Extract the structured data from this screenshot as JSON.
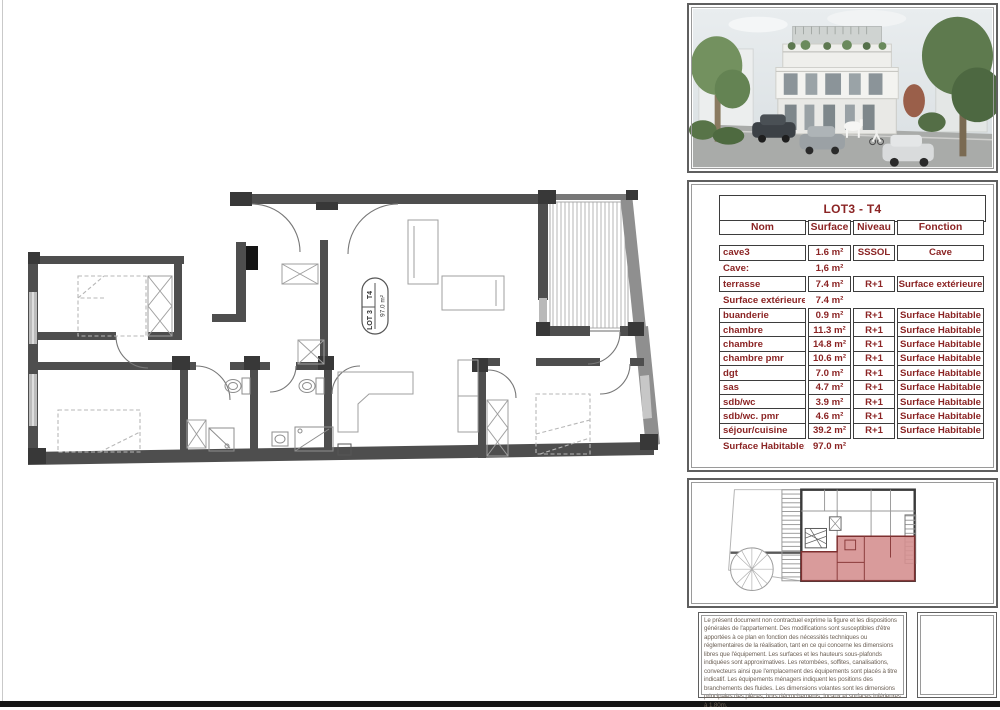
{
  "colors": {
    "accent_red": "#8b2424",
    "wall_gray": "#4e4e4e",
    "lot_highlight": "#d59090"
  },
  "plan": {
    "label": {
      "lot": "LOT 3",
      "type": "T4",
      "area": "97.0 m²"
    }
  },
  "table": {
    "title": "LOT3 - T4",
    "headers": [
      "Nom",
      "Surface",
      "Niveau",
      "Fonction"
    ],
    "rows": [
      {
        "nom": "cave3",
        "surface": "1.6 m²",
        "niveau": "SSSOL",
        "fonction": "Cave"
      },
      {
        "summary": true,
        "nom": "Cave:",
        "surface": "1,6 m²",
        "niveau": "",
        "fonction": ""
      },
      {
        "nom": "terrasse",
        "surface": "7.4 m²",
        "niveau": "R+1",
        "fonction": "Surface extérieure"
      },
      {
        "summary": true,
        "nom": "Surface extérieure: 1",
        "surface": "7.4 m²",
        "niveau": "",
        "fonction": ""
      },
      {
        "nom": "buanderie",
        "surface": "0.9 m²",
        "niveau": "R+1",
        "fonction": "Surface Habitable"
      },
      {
        "nom": "chambre",
        "surface": "11.3 m²",
        "niveau": "R+1",
        "fonction": "Surface Habitable"
      },
      {
        "nom": "chambre",
        "surface": "14.8 m²",
        "niveau": "R+1",
        "fonction": "Surface Habitable"
      },
      {
        "nom": "chambre pmr",
        "surface": "10.6 m²",
        "niveau": "R+1",
        "fonction": "Surface Habitable"
      },
      {
        "nom": "dgt",
        "surface": "7.0 m²",
        "niveau": "R+1",
        "fonction": "Surface Habitable"
      },
      {
        "nom": "sas",
        "surface": "4.7 m²",
        "niveau": "R+1",
        "fonction": "Surface Habitable"
      },
      {
        "nom": "sdb/wc",
        "surface": "3.9 m²",
        "niveau": "R+1",
        "fonction": "Surface Habitable"
      },
      {
        "nom": "sdb/wc. pmr",
        "surface": "4.6 m²",
        "niveau": "R+1",
        "fonction": "Surface Habitable"
      },
      {
        "nom": "séjour/cuisine",
        "surface": "39.2 m²",
        "niveau": "R+1",
        "fonction": "Surface Habitable"
      },
      {
        "summary": true,
        "nom": "Surface Habitable:",
        "surface": "97.0 m²",
        "niveau": "",
        "fonction": ""
      }
    ]
  },
  "legal": {
    "text": "Le présent document non contractuel exprime la figure et les dispositions générales de l'appartement. Des modifications sont susceptibles d'être apportées à ce plan en fonction des nécessités techniques ou réglementaires de la réalisation, tant en ce qui concerne les dimensions libres que l'équipement. Les surfaces et les hauteurs sous-plafonds indiquées sont approximatives. Les retombées, soffites, canalisations, convecteurs ainsi que l'emplacement des équipements sont placés à titre indicatif. Les équipements ménagers indiquent les positions des branchements des fluides. Les dimensions volantes sont les dimensions principales des pièces, hors décrochements, locaux et surfaces inférieures à 1.80m."
  }
}
